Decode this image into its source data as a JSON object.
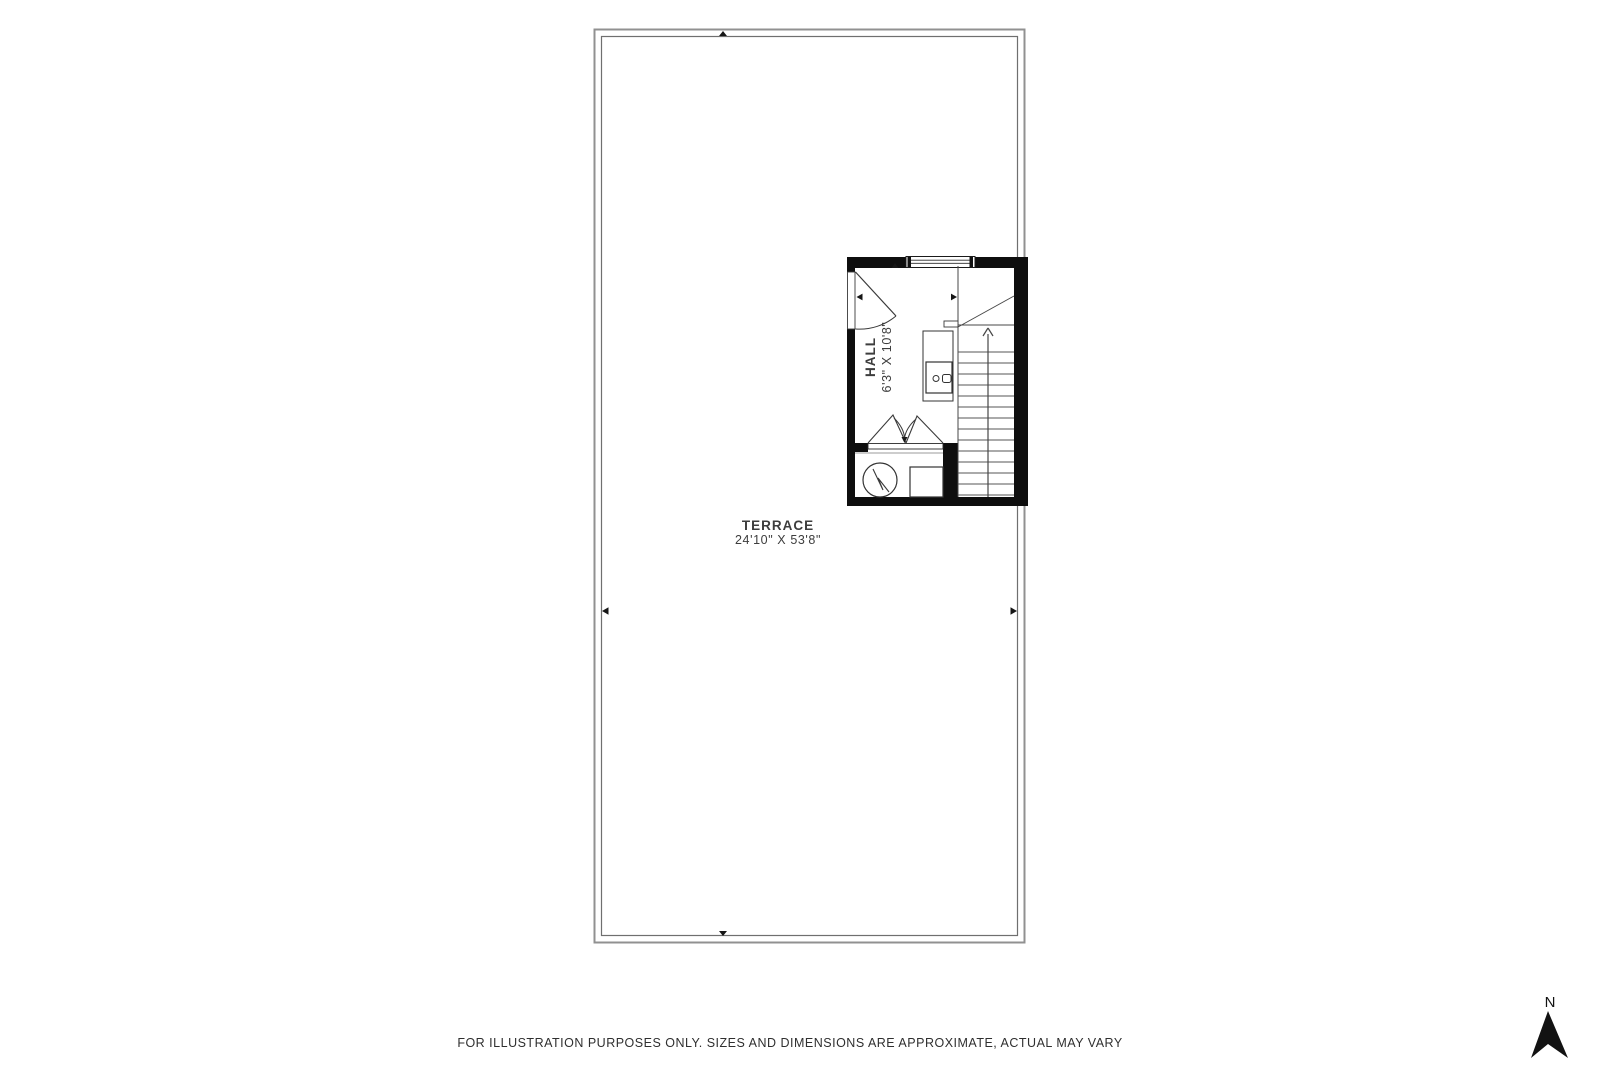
{
  "plan": {
    "terrace": {
      "name": "TERRACE",
      "dimensions": "24'10\" X 53'8\""
    },
    "hall": {
      "name": "HALL",
      "dimensions": "6'3\" X 10'8\""
    }
  },
  "compass": {
    "north": "N"
  },
  "footer": {
    "disclaimer": "FOR ILLUSTRATION PURPOSES ONLY. SIZES AND DIMENSIONS ARE APPROXIMATE, ACTUAL MAY VARY"
  },
  "colors": {
    "background": "#ffffff",
    "wall": "#0e0e0e",
    "terrace_border_outer": "#919191",
    "terrace_border_inner": "#6f6f6f",
    "line": "#474747",
    "text": "#3b3b3b"
  }
}
